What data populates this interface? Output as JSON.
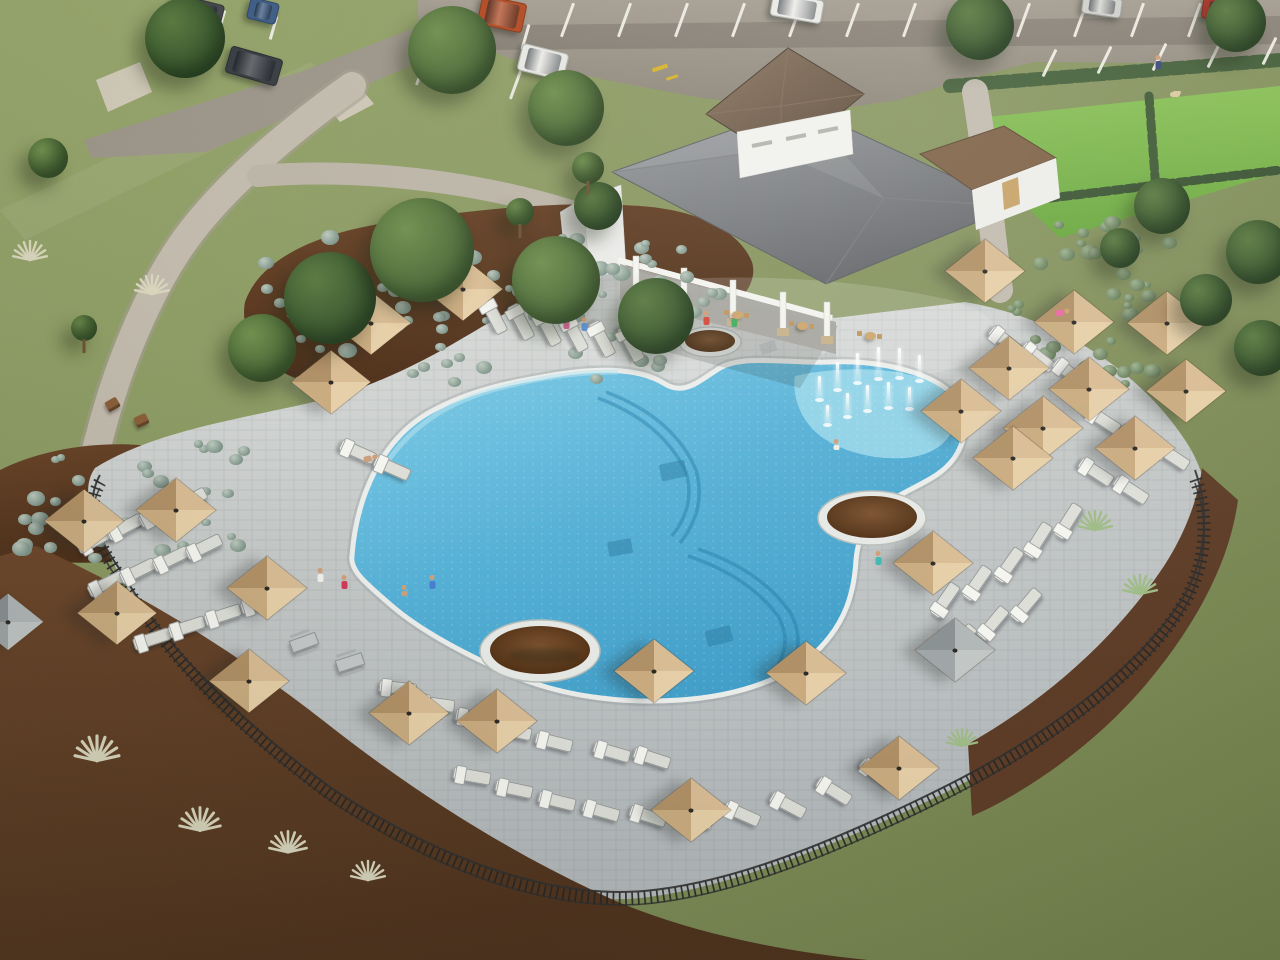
{
  "scene": {
    "type": "3d-architectural-rendering",
    "subject": "aerial view of a community resort-style amenity center with freeform pool, splash fountains, clubhouse, lounge chairs, tan umbrellas, parking lot and landscaped terraces",
    "text_visible": "none"
  },
  "palette": {
    "grass_light": "#98a76d",
    "grass_olive": "#6f7e4b",
    "lawn_bright": "#7eba4d",
    "asphalt": "#9b948a",
    "walkway": "#c3bcae",
    "deck": "#c6cac9",
    "deck_light": "#dfe1de",
    "pool_deep": "#3f9dc8",
    "pool_light": "#7fcde8",
    "splash": "#9cdaec",
    "coping": "#eef0ee",
    "umbrella_tan": "#d8bc94",
    "umbrella_gray": "#a8aeae",
    "mulch": "#5e3b25",
    "roof_gray": "#797b7f",
    "roof_brown": "#7e6247",
    "wall_white": "#f3f3f0",
    "fence_black": "#252525"
  },
  "objects": {
    "trees": [
      [
        185,
        38,
        40,
        0
      ],
      [
        452,
        50,
        44,
        1
      ],
      [
        566,
        108,
        38,
        1
      ],
      [
        48,
        158,
        20,
        1
      ],
      [
        980,
        26,
        34,
        0
      ],
      [
        1236,
        22,
        30,
        0
      ],
      [
        330,
        298,
        46,
        0
      ],
      [
        422,
        250,
        52,
        1
      ],
      [
        556,
        280,
        44,
        1
      ],
      [
        656,
        316,
        38,
        0
      ],
      [
        262,
        348,
        34,
        1
      ],
      [
        598,
        206,
        24,
        0
      ],
      [
        1162,
        206,
        28,
        0
      ],
      [
        1258,
        252,
        32,
        0
      ],
      [
        1206,
        300,
        26,
        0
      ],
      [
        1262,
        348,
        28,
        0
      ],
      [
        1120,
        248,
        20,
        0
      ],
      [
        588,
        168,
        16,
        1
      ],
      [
        520,
        212,
        14,
        1
      ],
      [
        84,
        328,
        13,
        1
      ]
    ],
    "palms": [
      [
        553,
        452,
        2.1,
        -8,
        198
      ],
      [
        712,
        190,
        1.45,
        0,
        148
      ],
      [
        893,
        352,
        1.5,
        -16,
        160
      ],
      [
        948,
        390,
        1.25,
        -42,
        128
      ],
      [
        598,
        82,
        1.0,
        0,
        0
      ],
      [
        884,
        44,
        1.15,
        0,
        0
      ],
      [
        1264,
        58,
        1.15,
        0,
        0
      ],
      [
        22,
        672,
        1.2,
        0,
        0
      ],
      [
        1092,
        218,
        0.85,
        0,
        0
      ],
      [
        880,
        130,
        0.8,
        0,
        0
      ]
    ],
    "umbrellas": [
      [
        463,
        289,
        1,
        0
      ],
      [
        371,
        323,
        1,
        0
      ],
      [
        331,
        382,
        1,
        0
      ],
      [
        985,
        271,
        1,
        0
      ],
      [
        1074,
        322,
        1,
        0
      ],
      [
        1009,
        368,
        1,
        0
      ],
      [
        1089,
        389,
        1,
        0
      ],
      [
        961,
        411,
        1,
        0
      ],
      [
        1043,
        428,
        1,
        0
      ],
      [
        1167,
        323,
        1,
        0
      ],
      [
        1186,
        391,
        1,
        0
      ],
      [
        1135,
        448,
        1,
        0
      ],
      [
        1013,
        458,
        1,
        0
      ],
      [
        933,
        563,
        1,
        0
      ],
      [
        955,
        650,
        1,
        1
      ],
      [
        806,
        673,
        1,
        0
      ],
      [
        899,
        768,
        1,
        0
      ],
      [
        654,
        671,
        1,
        0
      ],
      [
        691,
        810,
        1,
        0
      ],
      [
        497,
        721,
        1,
        0
      ],
      [
        84,
        521,
        1,
        0
      ],
      [
        176,
        510,
        1,
        0
      ],
      [
        117,
        613,
        1,
        0
      ],
      [
        267,
        588,
        1,
        0
      ],
      [
        249,
        681,
        1,
        0
      ],
      [
        409,
        713,
        1,
        0
      ],
      [
        8,
        622,
        0.9,
        1
      ]
    ],
    "loungers": [
      [
        494,
        316,
        62
      ],
      [
        521,
        322,
        62
      ],
      [
        548,
        328,
        62
      ],
      [
        575,
        334,
        62
      ],
      [
        602,
        339,
        62
      ],
      [
        631,
        344,
        62
      ],
      [
        358,
        452,
        24
      ],
      [
        392,
        468,
        24
      ],
      [
        95,
        540,
        -28
      ],
      [
        125,
        527,
        -28
      ],
      [
        157,
        514,
        -28
      ],
      [
        189,
        501,
        -28
      ],
      [
        106,
        584,
        -26
      ],
      [
        138,
        571,
        -26
      ],
      [
        171,
        559,
        -26
      ],
      [
        204,
        547,
        -26
      ],
      [
        152,
        639,
        -18
      ],
      [
        187,
        627,
        -18
      ],
      [
        223,
        615,
        -18
      ],
      [
        259,
        603,
        -18
      ],
      [
        398,
        688,
        6
      ],
      [
        436,
        704,
        8
      ],
      [
        474,
        718,
        10
      ],
      [
        513,
        731,
        12
      ],
      [
        554,
        742,
        14
      ],
      [
        612,
        752,
        16
      ],
      [
        652,
        758,
        18
      ],
      [
        472,
        776,
        10
      ],
      [
        514,
        789,
        12
      ],
      [
        557,
        801,
        14
      ],
      [
        601,
        811,
        16
      ],
      [
        648,
        816,
        18
      ],
      [
        695,
        818,
        20
      ],
      [
        742,
        814,
        24
      ],
      [
        788,
        805,
        28
      ],
      [
        834,
        791,
        32
      ],
      [
        877,
        773,
        36
      ],
      [
        945,
        600,
        -55
      ],
      [
        977,
        583,
        -55
      ],
      [
        1009,
        565,
        -55
      ],
      [
        961,
        641,
        -50
      ],
      [
        993,
        623,
        -50
      ],
      [
        1026,
        605,
        -50
      ],
      [
        1038,
        540,
        -58
      ],
      [
        1068,
        521,
        -58
      ],
      [
        1006,
        341,
        38
      ],
      [
        1038,
        357,
        38
      ],
      [
        1070,
        373,
        38
      ],
      [
        1103,
        420,
        33
      ],
      [
        1138,
        438,
        33
      ],
      [
        1172,
        456,
        33
      ],
      [
        1096,
        472,
        33
      ],
      [
        1131,
        490,
        33
      ]
    ],
    "cars": [
      [
        197,
        12,
        52,
        26,
        14,
        "#44474c"
      ],
      [
        263,
        11,
        30,
        22,
        14,
        "#3f5d85"
      ],
      [
        502,
        14,
        46,
        30,
        12,
        "#b04a22"
      ],
      [
        797,
        8,
        52,
        24,
        10,
        "#e9e9e6"
      ],
      [
        1222,
        10,
        40,
        22,
        8,
        "#a83324"
      ],
      [
        1102,
        6,
        40,
        20,
        8,
        "#cfcfcb"
      ],
      [
        254,
        66,
        54,
        28,
        16,
        "#3a3d42"
      ],
      [
        543,
        62,
        48,
        28,
        14,
        "#e6e6e2"
      ]
    ],
    "stripe_rows": [
      [
        566,
        2,
        13,
        57,
        0,
        36,
        20
      ],
      [
        1048,
        48,
        5,
        55,
        -3,
        30,
        26
      ],
      [
        434,
        8,
        3,
        45,
        8,
        26,
        16
      ],
      [
        420,
        56,
        4,
        47,
        7,
        30,
        20
      ],
      [
        168,
        4,
        3,
        52,
        6,
        24,
        16
      ]
    ],
    "people": [
      [
        566,
        330,
        0,
        "#e86aa0"
      ],
      [
        584,
        332,
        0,
        "#5b8fd4"
      ],
      [
        706,
        326,
        0,
        "#d44a3a"
      ],
      [
        734,
        328,
        0,
        "#3fae62"
      ],
      [
        432,
        590,
        0,
        "#4a7fd0"
      ],
      [
        320,
        583,
        0,
        "#f0f0ea"
      ],
      [
        344,
        590,
        0,
        "#d03a5a"
      ],
      [
        878,
        566,
        0,
        "#40b8b0"
      ],
      [
        1158,
        70,
        0,
        "#3a4a7a"
      ],
      [
        836,
        450,
        1,
        "#f0ece4"
      ],
      [
        404,
        596,
        1,
        "#caa07d"
      ],
      [
        1062,
        312,
        2,
        "#e86aa0"
      ],
      [
        370,
        458,
        2,
        "#caa07d"
      ]
    ],
    "jets": [
      [
        818,
        400,
        24
      ],
      [
        836,
        390,
        28
      ],
      [
        856,
        383,
        30
      ],
      [
        877,
        379,
        32
      ],
      [
        898,
        378,
        30
      ],
      [
        918,
        381,
        26
      ],
      [
        826,
        425,
        20
      ],
      [
        846,
        417,
        24
      ],
      [
        866,
        411,
        26
      ],
      [
        887,
        408,
        26
      ],
      [
        908,
        409,
        22
      ]
    ],
    "fans": [
      [
        30,
        258,
        1,
        0
      ],
      [
        152,
        292,
        1,
        0
      ],
      [
        97,
        758,
        1.3,
        0
      ],
      [
        200,
        828,
        1.2,
        0
      ],
      [
        288,
        850,
        1.1,
        0
      ],
      [
        368,
        878,
        1,
        0
      ],
      [
        1095,
        528,
        1,
        1
      ],
      [
        1140,
        592,
        1,
        1
      ],
      [
        962,
        744,
        0.9,
        1
      ]
    ],
    "tables_patio": [
      [
        672,
        303
      ],
      [
        737,
        314
      ],
      [
        802,
        325
      ],
      [
        870,
        335
      ]
    ],
    "tables_deck": [
      [
        303,
        641,
        -20
      ],
      [
        349,
        661,
        -18
      ]
    ],
    "benches": [
      [
        112,
        404,
        -30
      ],
      [
        141,
        420,
        -25
      ]
    ],
    "shrub_patches": [
      [
        258,
        228,
        420,
        150,
        64,
        0
      ],
      [
        2,
        438,
        240,
        115,
        34,
        0
      ],
      [
        998,
        212,
        170,
        118,
        26,
        1
      ],
      [
        1030,
        298,
        150,
        92,
        18,
        1
      ],
      [
        598,
        238,
        120,
        70,
        14,
        0
      ]
    ],
    "terrace_rows": [
      [
        0,
        583,
        250,
        660,
        520,
        858,
        16
      ],
      [
        0,
        640,
        230,
        712,
        458,
        888,
        14
      ],
      [
        0,
        700,
        200,
        762,
        400,
        915,
        12
      ],
      [
        0,
        760,
        168,
        816,
        330,
        936,
        10
      ],
      [
        0,
        824,
        120,
        866,
        252,
        950,
        8
      ],
      [
        30,
        892,
        90,
        916,
        180,
        956,
        5
      ],
      [
        540,
        878,
        660,
        918,
        800,
        952,
        7
      ]
    ],
    "green_tufts": [
      [
        1002,
        712
      ],
      [
        1032,
        690
      ],
      [
        1060,
        666
      ],
      [
        1086,
        640
      ],
      [
        1110,
        612
      ],
      [
        1132,
        584
      ],
      [
        1152,
        556
      ],
      [
        1168,
        528
      ],
      [
        1010,
        748
      ],
      [
        1046,
        724
      ],
      [
        1078,
        698
      ],
      [
        1106,
        672
      ],
      [
        1190,
        500
      ],
      [
        984,
        768
      ]
    ]
  }
}
